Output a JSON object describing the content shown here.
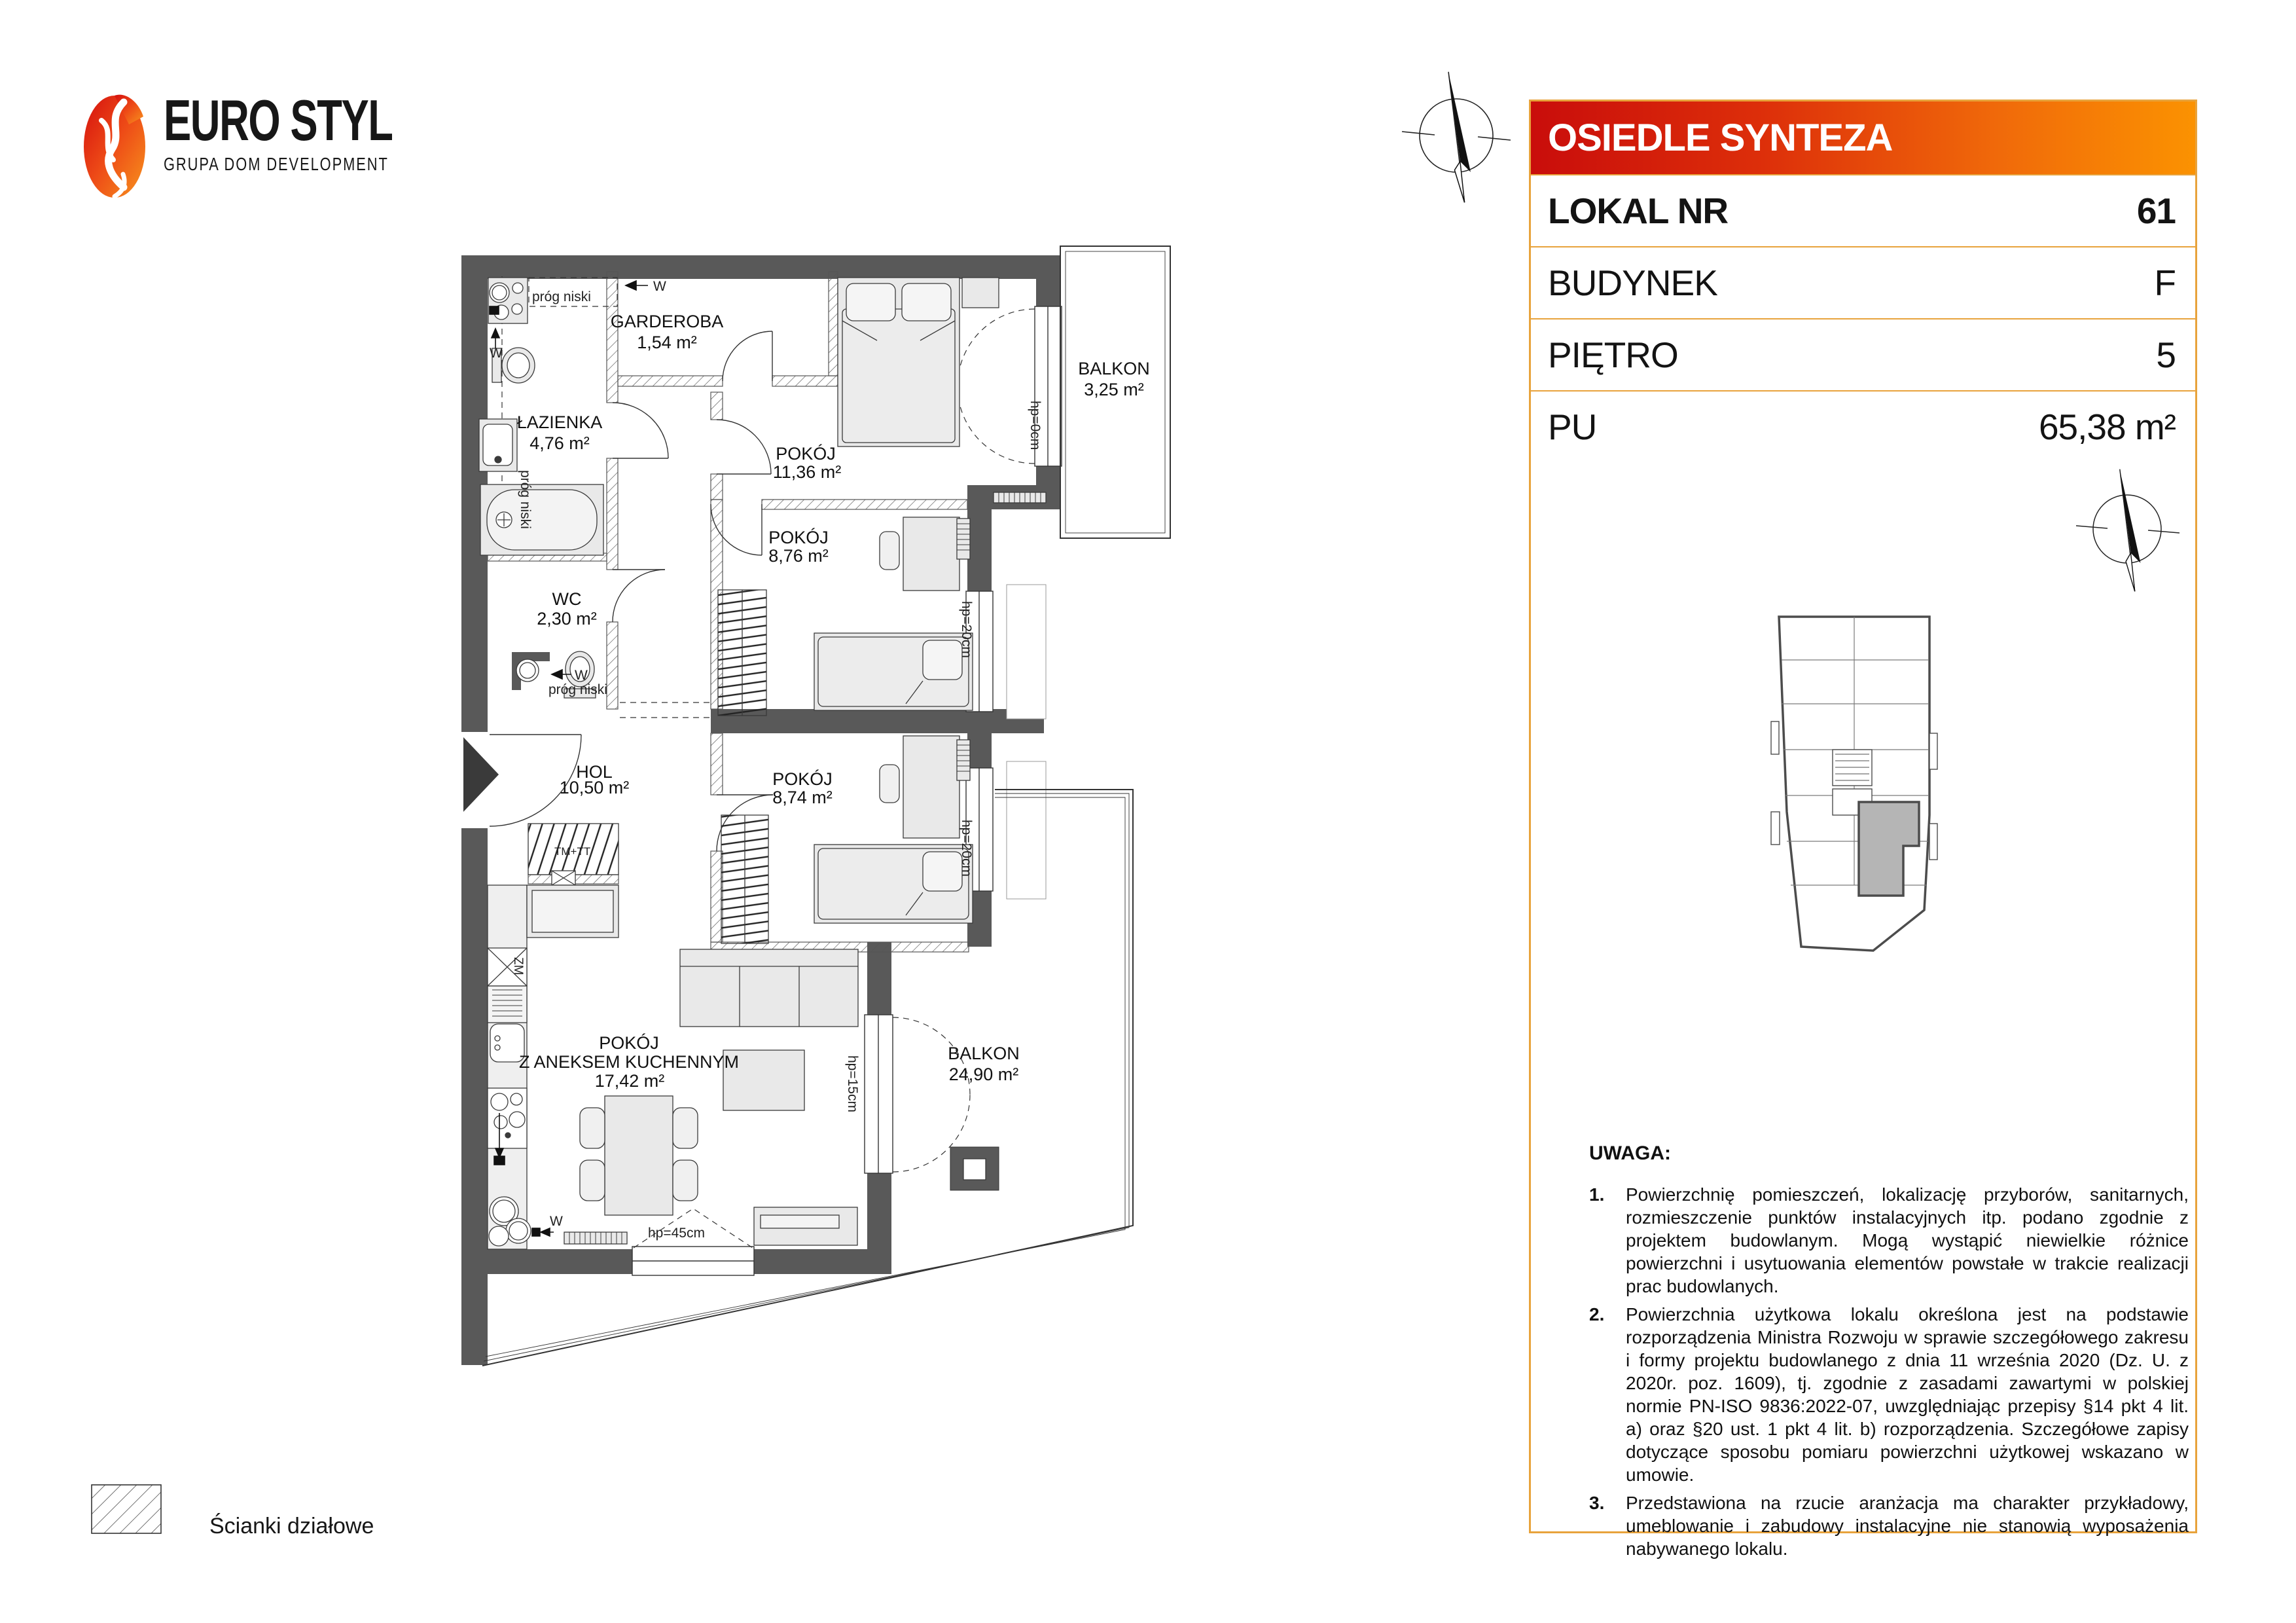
{
  "logo": {
    "brand": "EURO STYL",
    "subtitle": "GRUPA DOM DEVELOPMENT"
  },
  "header": {
    "title": "OSIEDLE SYNTEZA",
    "rows": [
      {
        "label": "LOKAL NR",
        "value": "61"
      },
      {
        "label": "BUDYNEK",
        "value": "F"
      },
      {
        "label": "PIĘTRO",
        "value": "5"
      },
      {
        "label": "PU",
        "value": "65,38 m²"
      }
    ]
  },
  "colors": {
    "accent_red": "#c90d0b",
    "accent_orange": "#fb9201",
    "panel_border": "#e8a33c",
    "wall_gray": "#595959",
    "furniture_fill": "#e9e9e9",
    "unit_highlight": "#b5b5b5"
  },
  "plan": {
    "rooms": [
      {
        "name": "GARDEROBA",
        "area": "1,54 m²"
      },
      {
        "name": "ŁAZIENKA",
        "area": "4,76 m²"
      },
      {
        "name": "POKÓJ",
        "area": "11,36 m²"
      },
      {
        "name": "POKÓJ",
        "area": "8,76 m²"
      },
      {
        "name": "WC",
        "area": "2,30 m²"
      },
      {
        "name": "HOL",
        "area": "10,50 m²"
      },
      {
        "name": "POKÓJ",
        "area": "8,74 m²"
      },
      {
        "name": "POKÓJ",
        "sub": "Z ANEKSEM KUCHENNYM",
        "area": "17,42 m²"
      },
      {
        "name": "BALKON",
        "area": "3,25 m²"
      },
      {
        "name": "BALKON",
        "area": "24,90 m²"
      }
    ],
    "annotations": {
      "hp0": "hp=0cm",
      "hp20": "hp=20cm",
      "hp45": "hp=45cm",
      "hp15": "hp=15cm",
      "prog": "próg niski",
      "w": "W",
      "tm": "TM+TT",
      "zm": "ZM"
    }
  },
  "legend": {
    "label": "Ścianki działowe"
  },
  "notes": {
    "title": "UWAGA:",
    "items": [
      {
        "num": "1.",
        "text": "Powierzchnię pomieszczeń, lokalizację przyborów, sanitarnych, rozmieszczenie punktów instalacyjnych itp. podano zgodnie z projektem budowlanym. Mogą wystąpić niewielkie różnice powierzchni i usytuowania elementów powstałe w trakcie realizacji prac budowlanych."
      },
      {
        "num": "2.",
        "text": "Powierzchnia użytkowa lokalu określona jest na podstawie rozporządzenia Ministra Rozwoju w sprawie szczegółowego zakresu i formy projektu budowlanego z dnia 11 września 2020 (Dz. U. z 2020r. poz. 1609), tj. zgodnie z zasadami zawartymi w polskiej normie PN-ISO 9836:2022-07, uwzględniając przepisy §14 pkt 4 lit. a) oraz §20 ust. 1 pkt 4 lit. b) rozporządzenia. Szczegółowe zapisy dotyczące sposobu pomiaru powierzchni użytkowej wskazano w umowie."
      },
      {
        "num": "3.",
        "text": "Przedstawiona na rzucie aranżacja ma charakter przykładowy, umeblowanie i zabudowy instalacyjne nie stanowią wyposażenia nabywanego lokalu."
      }
    ]
  }
}
